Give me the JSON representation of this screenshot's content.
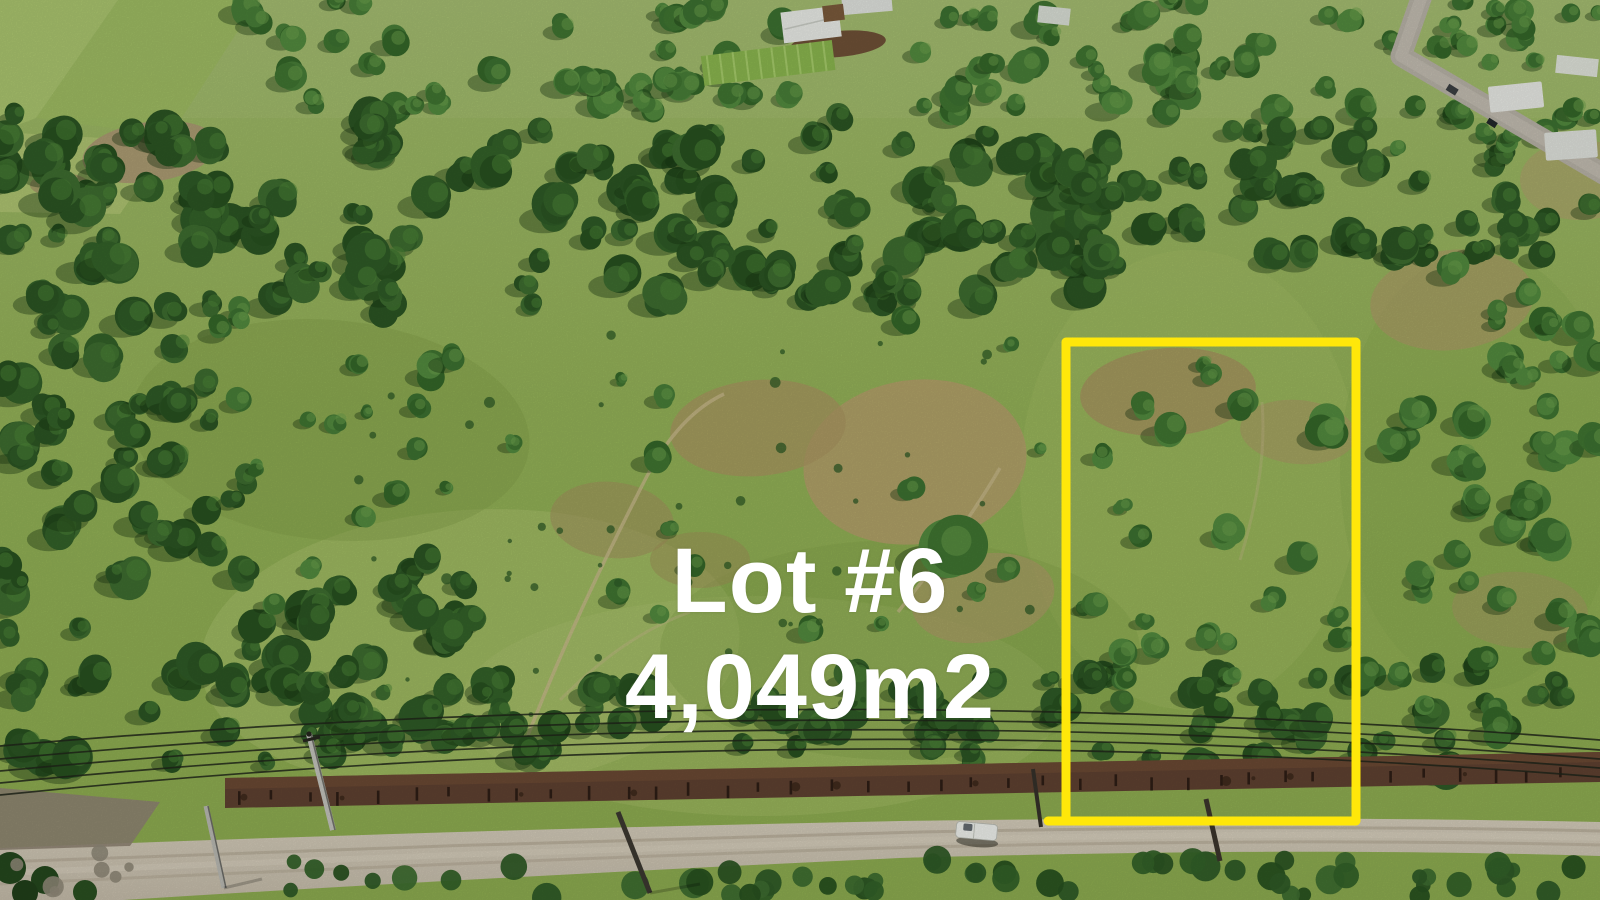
{
  "labels": {
    "lot_number": "Lot #6",
    "lot_area": "4,049m2",
    "text_color": "#ffffff"
  },
  "boundary": {
    "color": "#ffe70a"
  },
  "scene": {
    "type": "aerial-drone-photo",
    "features": {
      "terrain": "green pasture with scattered trees and dry patches",
      "road": "dirt road along bottom",
      "paved_road": "paved road top right",
      "vehicle": "white pickup truck on dirt road",
      "power_lines": "overhead power lines with utility poles",
      "buildings": "farm houses with white roofs at top",
      "fence": "fence line with red-brown soil strip"
    }
  },
  "palette": {
    "pasture": "#93b157",
    "forest": "#2e5a26",
    "dry_dirt": "#ab9a66",
    "dirt_road": "#ccc3b1",
    "fence_soil": "#5e4130",
    "boundary_yellow": "#ffe70a",
    "text_white": "#ffffff"
  }
}
